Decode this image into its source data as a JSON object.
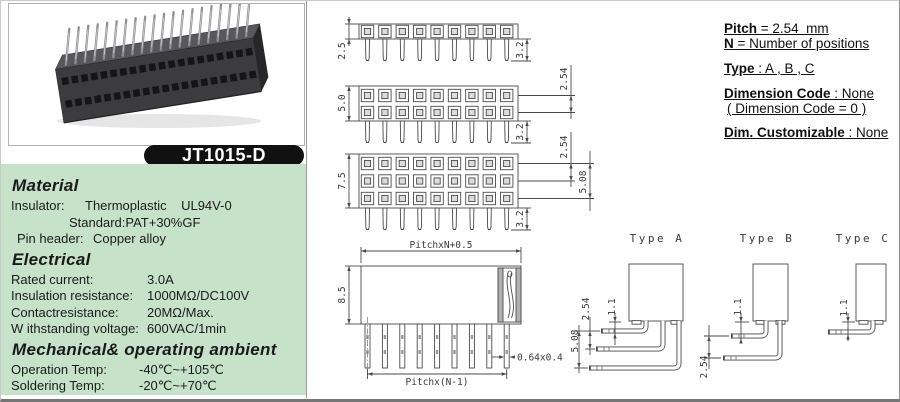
{
  "product": {
    "model": "JT1015-D"
  },
  "specs": {
    "material": {
      "heading": "Material",
      "rows": [
        {
          "label": "Insulator:",
          "value": "Thermoplastic    UL94V-0"
        },
        {
          "label": "",
          "value": "Standard:PAT+30%GF"
        },
        {
          "label": "Pin header:",
          "value": "Copper alloy"
        }
      ]
    },
    "electrical": {
      "heading": "Electrical",
      "rows": [
        {
          "label": "Rated current:",
          "value": "3.0A"
        },
        {
          "label": "Insulation resistance:",
          "value": "1000MΩ/DC100V"
        },
        {
          "label": "Contactresistance:",
          "value": "20MΩ/Max."
        },
        {
          "label": "W ithstanding voltage:",
          "value": "600VAC/1min"
        }
      ]
    },
    "mechanical": {
      "heading": "Mechanical& operating ambient",
      "rows": [
        {
          "label": "Operation Temp:",
          "value": "-40℃~+105℃"
        },
        {
          "label": "Soldering Temp:",
          "value": "-20℃~+70℃"
        }
      ]
    }
  },
  "notes": {
    "lines": [
      {
        "b": "Pitch",
        "t": " = 2.54  mm"
      },
      {
        "b": "N",
        "t": " = Number of positions"
      },
      {
        "b": "Type",
        "t": " : A , B , C"
      },
      {
        "b": "Dimension Code",
        "t": " : None"
      },
      {
        "b": "",
        "t": "( Dimension Code = 0 )"
      },
      {
        "b": "Dim. Customizable",
        "t": " : None"
      }
    ]
  },
  "drawings": {
    "positions_shown": 9,
    "view1": {
      "height": "2.5",
      "tail": "3.2"
    },
    "view2": {
      "height": "5.0",
      "row_pitch": "2.54",
      "tail": "3.2"
    },
    "view3": {
      "height": "7.5",
      "row_pitch": "2.54",
      "row_pitch2": "5.08",
      "tail": "3.2"
    },
    "side_view": {
      "width": "PitchxN+0.5",
      "height": "8.5",
      "span": "Pitchx(N-1)",
      "pin_size": "0.64x0.4"
    }
  },
  "types": {
    "a": {
      "label": "Type A",
      "offset": "1.1",
      "pitch": "2.54",
      "pitch2": "5.08"
    },
    "b": {
      "label": "Type B",
      "offset": "1.1",
      "pitch": "2.54"
    },
    "c": {
      "label": "Type C",
      "offset": "1.1"
    }
  },
  "colors": {
    "panel_green": "#c6e3ca",
    "badge_black": "#111111",
    "line_gray": "#4a4a4a"
  }
}
